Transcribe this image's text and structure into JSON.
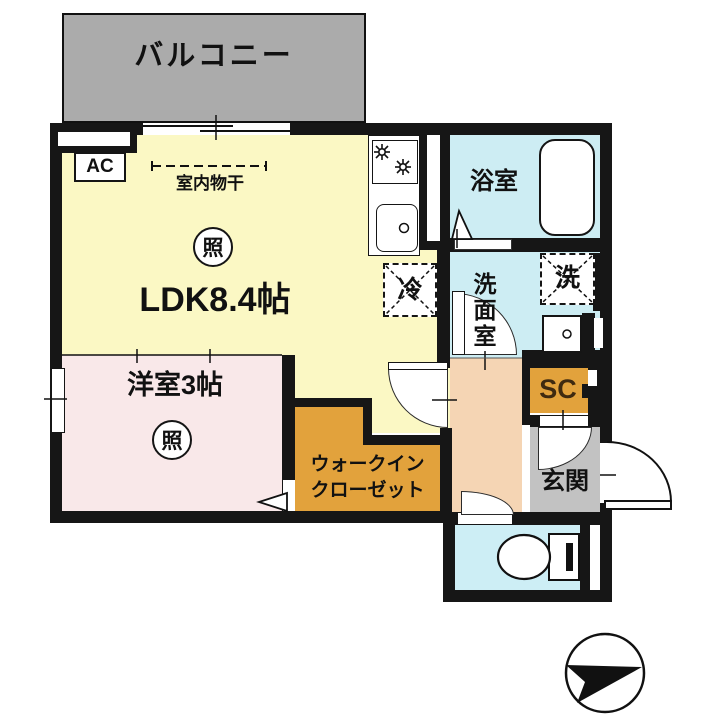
{
  "colors": {
    "wall": "#161616",
    "balcony": "#ababab",
    "ldk": "#fbf8c4",
    "western": "#f9e8e9",
    "wic": "#e2a23c",
    "hall": "#f5d5b4",
    "genkan": "#c2c2c2",
    "bath": "#cdedf3",
    "toilet": "#cdeef5",
    "sc_text": "#3f2a10"
  },
  "labels": {
    "balcony": "バルコニー",
    "ac": "AC",
    "indoor_drying": "室内物干",
    "light": "照",
    "ldk": "LDK8.4帖",
    "western_room": "洋室3帖",
    "wic_line1": "ウォークイン",
    "wic_line2": "クローゼット",
    "bathroom": "浴室",
    "washroom": "洗面室",
    "washer": "洗",
    "fridge": "冷",
    "shoe_closet": "SC",
    "entrance": "玄関"
  }
}
